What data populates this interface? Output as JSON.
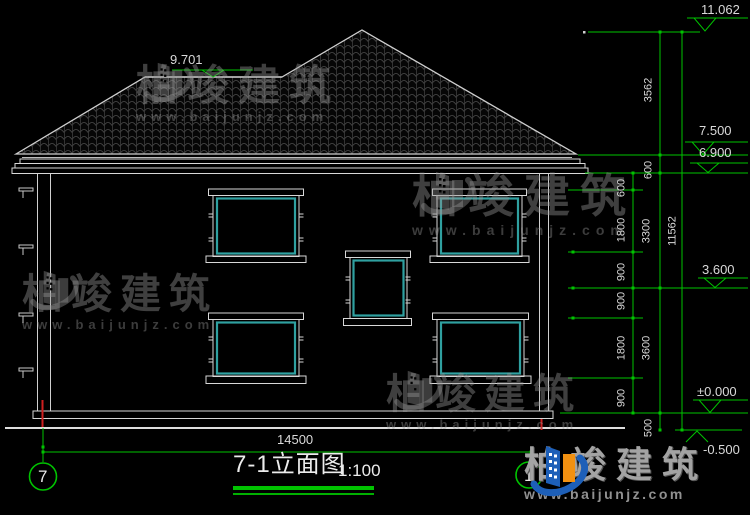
{
  "drawing": {
    "title": "7-1立面图",
    "scale": "1:100",
    "axis_left": "7",
    "axis_right": "1",
    "levels": {
      "ridge_top": "11.062",
      "roof_ridge": "9.701",
      "eave_top": "7.500",
      "wall_top": "6.900",
      "floor2": "3.600",
      "floor1": "±0.000",
      "ground": "-0.500"
    },
    "dims": {
      "overall_width": "14500",
      "total_height": "11562",
      "floor_chain": [
        "3562",
        "600",
        "3300",
        "3600",
        "500"
      ],
      "opening_chain": [
        "600",
        "1800",
        "900",
        "900",
        "1800",
        "900"
      ]
    }
  },
  "watermark": {
    "brand": "柏竣建筑",
    "url": "www.baijunjz.com"
  },
  "logo": {
    "brand": "柏竣建筑",
    "url": "www.baijunjz.com"
  },
  "colors": {
    "background": "#000000",
    "line_white": "#d8d8d8",
    "dim_green": "#00c300",
    "window_teal": "#2fa0a0",
    "axis_red": "#cf1f1f",
    "watermark_gray": "#3e3e3e",
    "logo_blue": "#1d5fb8",
    "logo_orange": "#f29111"
  }
}
